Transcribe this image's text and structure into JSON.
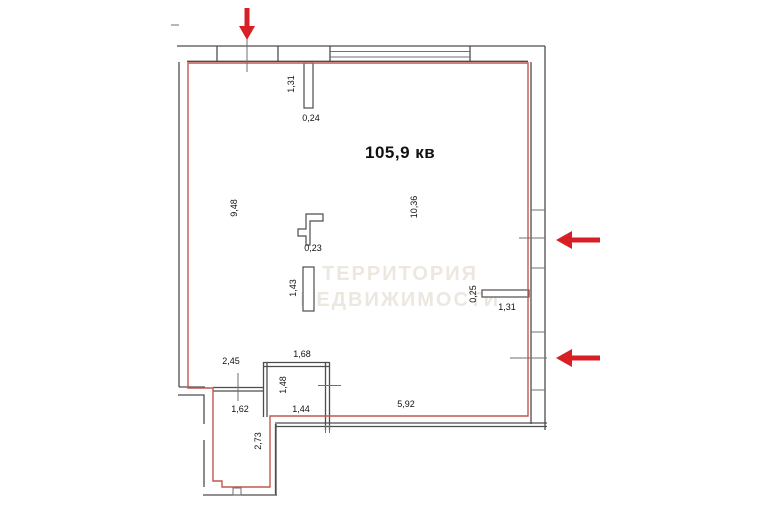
{
  "plan": {
    "area_label": "105,9 кв",
    "watermark_line1": "ТЕРРИТОРИЯ",
    "watermark_line2": "НЕДВИЖИМОСТИ"
  },
  "dims": {
    "top_opening_height": "1,31",
    "top_stub_width": "0,24",
    "left_wall_length": "9,48",
    "right_side_length": "10,36",
    "column_width": "0,23",
    "partition_length": "1,43",
    "right_stub_depth": "0,25",
    "right_stub_length": "1,31",
    "corridor_width": "2,45",
    "closet_width": "1,68",
    "hallway_width": "1,62",
    "closet_depth": "1,48",
    "closet_bottom_width": "1,44",
    "bottom_wall_length": "5,92",
    "hallway_depth": "2,73"
  },
  "colors": {
    "apartment_boundary": "#c4564f",
    "arrow_red": "#d91f26",
    "wall_gray": "#4d4d4d",
    "dimension_text": "#111111",
    "watermark": "#ded5c6"
  }
}
